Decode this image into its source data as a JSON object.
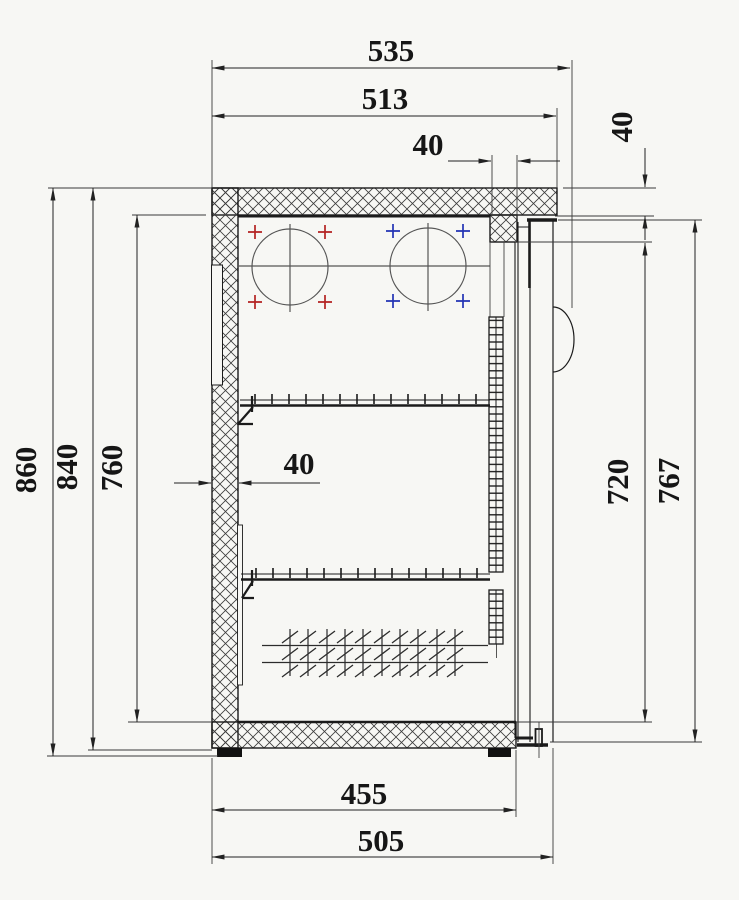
{
  "drawing": {
    "kind": "refrigerated-cabinet-side-section",
    "units": "mm",
    "dimensions": {
      "top_overall_depth": "535",
      "top_body_depth": "513",
      "top_door_gap": "40",
      "top_right_thickness": "40",
      "left_total_height": "860",
      "left_body_height": "840",
      "left_interior_height": "760",
      "wall_thickness": "40",
      "right_interior_height": "720",
      "right_door_height": "767",
      "bottom_interior_depth": "455",
      "bottom_overall_depth": "505"
    },
    "colors": {
      "background": "#f7f7f4",
      "line": "#1e1e1e",
      "dim_line": "#2a2a2a",
      "fan_cross_left": "#b42222",
      "fan_cross_right": "#2233b4"
    }
  }
}
